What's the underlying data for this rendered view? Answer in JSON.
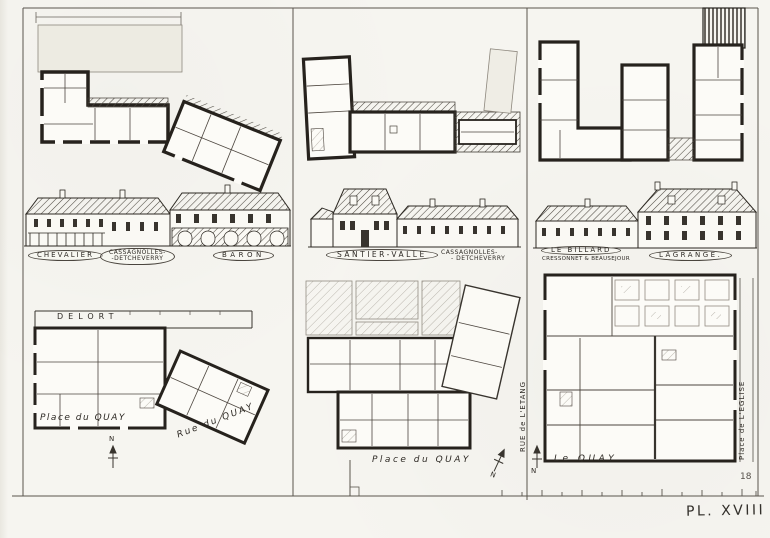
{
  "plate": {
    "label": "PL. XVIII",
    "page_number": "18"
  },
  "colors": {
    "paper": "#f6f5f0",
    "ink": "#26221d"
  },
  "north_mark": "N",
  "labels": {
    "left": {
      "oval1": "CHEVALIER",
      "oval2_line1": "CASSAGNOLLES-",
      "oval2_line2": "-DETCHEVERRY",
      "oval3": "BARON",
      "plan_owner": "DELORT",
      "street_place": "Place du QUAY",
      "street_rue": "Rue du QUAY"
    },
    "middle": {
      "oval1": "SANTIER-VALLE",
      "owner_line1": "CASSAGNOLLES-",
      "owner_line2": "- DETCHEVERRY",
      "street_place": "Place du QUAY"
    },
    "right": {
      "oval1": "LE BILLARD",
      "oval1_sub": "CRESSONNET & BEAUSEJOUR",
      "oval2": "LAGRANGE.",
      "street_etang": "RUE de L'ETANG",
      "street_quay": "Le QUAY",
      "street_eglise": "Place de L'EGLISE"
    }
  }
}
